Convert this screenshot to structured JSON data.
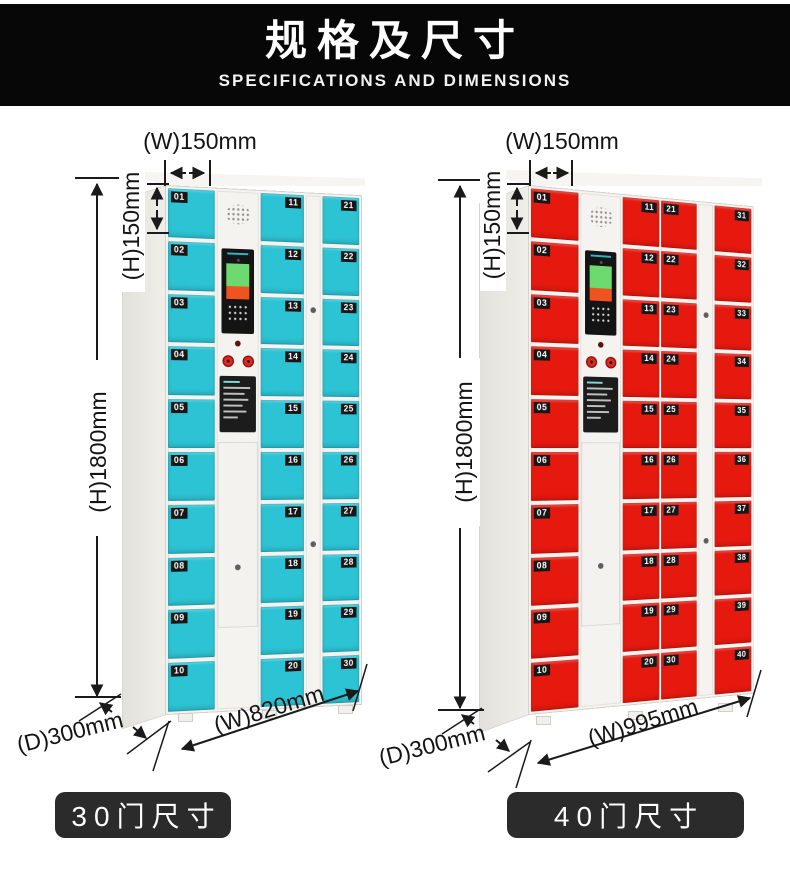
{
  "header": {
    "title": "规格及尺寸",
    "subtitle": "SPECIFICATIONS AND DIMENSIONS"
  },
  "lockers": [
    {
      "id": "locker-30",
      "label": "30门尺寸",
      "door_color": "#2cc3d4",
      "dims": {
        "top_width": "(W)150mm",
        "door_height": "(H)150mm",
        "height": "(H)1800mm",
        "depth": "(D)300mm",
        "width": "(W)820mm"
      },
      "columns": [
        {
          "type": "doors",
          "badge_side": "left",
          "numbers": [
            "01",
            "02",
            "03",
            "04",
            "05",
            "06",
            "07",
            "08",
            "09",
            "10"
          ]
        },
        {
          "type": "control"
        },
        {
          "type": "doors",
          "badge_side": "right",
          "numbers": [
            "11",
            "12",
            "13",
            "14",
            "15",
            "16",
            "17",
            "18",
            "19",
            "20"
          ]
        },
        {
          "type": "strip"
        },
        {
          "type": "doors",
          "badge_side": "right",
          "numbers": [
            "21",
            "22",
            "23",
            "24",
            "25",
            "26",
            "27",
            "28",
            "29",
            "30"
          ]
        }
      ]
    },
    {
      "id": "locker-40",
      "label": "40门尺寸",
      "door_color": "#e6190f",
      "dims": {
        "top_width": "(W)150mm",
        "door_height": "(H)150mm",
        "height": "(H)1800mm",
        "depth": "(D)300mm",
        "width": "(W)995mm"
      },
      "columns": [
        {
          "type": "doors",
          "badge_side": "left",
          "numbers": [
            "01",
            "02",
            "03",
            "04",
            "05",
            "06",
            "07",
            "08",
            "09",
            "10"
          ]
        },
        {
          "type": "control"
        },
        {
          "type": "doors",
          "badge_side": "right",
          "numbers": [
            "11",
            "12",
            "13",
            "14",
            "15",
            "16",
            "17",
            "18",
            "19",
            "20"
          ]
        },
        {
          "type": "doors",
          "badge_side": "left",
          "numbers": [
            "21",
            "22",
            "23",
            "24",
            "25",
            "26",
            "27",
            "28",
            "29",
            "30"
          ]
        },
        {
          "type": "strip"
        },
        {
          "type": "doors",
          "badge_side": "right",
          "numbers": [
            "31",
            "32",
            "33",
            "34",
            "35",
            "36",
            "37",
            "38",
            "39",
            "40"
          ]
        }
      ]
    }
  ]
}
